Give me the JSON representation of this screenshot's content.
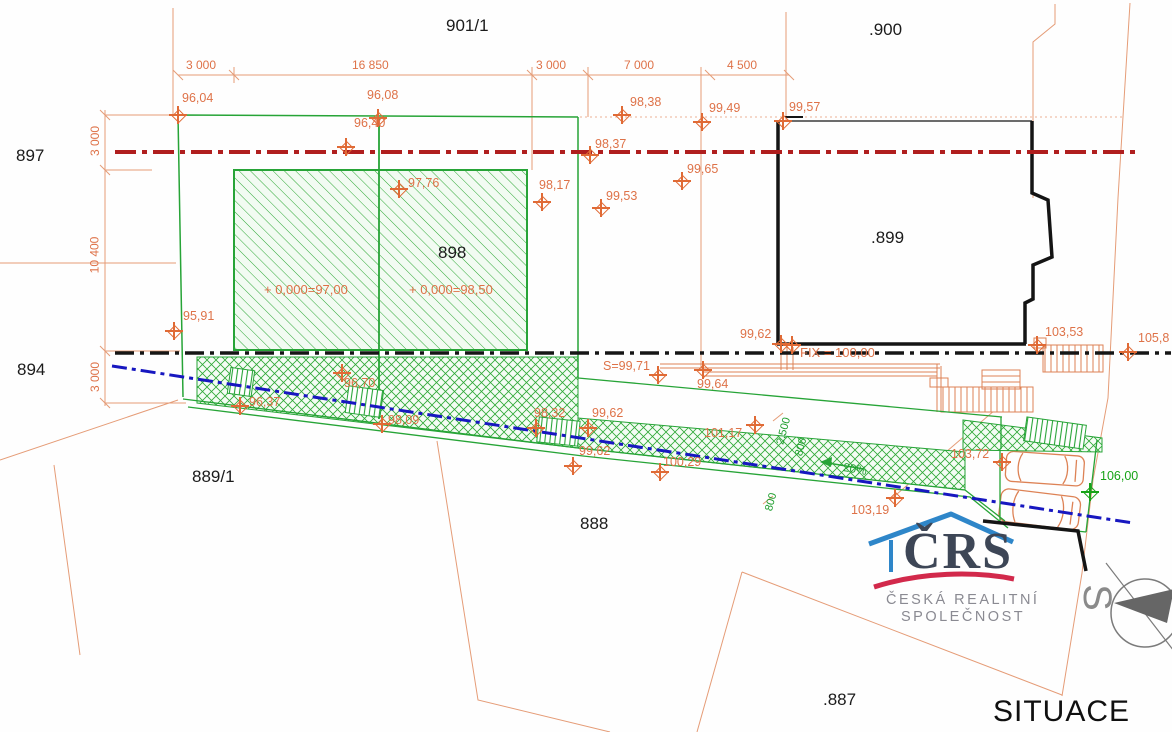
{
  "drawing_title": "SITUACE",
  "north_label": "S",
  "logo": {
    "name": "ČRS",
    "line1": "ČESKÁ REALITNÍ",
    "line2": "SPOLEČNOST"
  },
  "colors": {
    "green": "#27a437",
    "orange_text": "#de7248",
    "orange_line": "#e59c77",
    "red_axis": "#b01e1e",
    "black_axis": "#161616",
    "blue_axis": "#1717c0",
    "logo_blue": "#2e86c9",
    "logo_red": "#d2294b",
    "logo_gray": "#8a8a92"
  },
  "parcel_labels": [
    {
      "text": "901/1",
      "x": 446,
      "y": 16
    },
    {
      "text": ".900",
      "x": 869,
      "y": 20
    },
    {
      "text": "897",
      "x": 16,
      "y": 146
    },
    {
      "text": "894",
      "x": 17,
      "y": 360
    },
    {
      "text": "898",
      "x": 438,
      "y": 243
    },
    {
      "text": ".899",
      "x": 871,
      "y": 228
    },
    {
      "text": "889/1",
      "x": 192,
      "y": 467
    },
    {
      "text": "888",
      "x": 580,
      "y": 514
    },
    {
      "text": ".887",
      "x": 823,
      "y": 690
    }
  ],
  "dimension_labels_top": [
    {
      "text": "3 000",
      "x": 186,
      "y": 58
    },
    {
      "text": "16 850",
      "x": 352,
      "y": 58
    },
    {
      "text": "3 000",
      "x": 536,
      "y": 58
    },
    {
      "text": "7 000",
      "x": 624,
      "y": 58
    },
    {
      "text": "4 500",
      "x": 727,
      "y": 58
    }
  ],
  "dimension_labels_left": [
    {
      "text": "3 000",
      "x": 80,
      "y": 134
    },
    {
      "text": "10 400",
      "x": 76,
      "y": 248
    },
    {
      "text": "3 000",
      "x": 80,
      "y": 370
    }
  ],
  "dimension_labels_ramp": [
    {
      "text": "2,500",
      "x": 770,
      "y": 425,
      "rot": -75
    },
    {
      "text": "800",
      "x": 792,
      "y": 441,
      "rot": -75
    },
    {
      "text": "800",
      "x": 762,
      "y": 496,
      "rot": -75
    }
  ],
  "annotations": [
    {
      "text": "+ 0,000=97,00",
      "x": 264,
      "y": 282,
      "color": "orange"
    },
    {
      "text": "+ 0,000=98,50",
      "x": 409,
      "y": 282,
      "color": "orange"
    },
    {
      "text": "FIX = 100,00",
      "x": 800,
      "y": 345,
      "color": "orange"
    },
    {
      "text": "20%",
      "x": 843,
      "y": 462,
      "color": "green",
      "rot": 10
    }
  ],
  "elevation_points": [
    {
      "label": "96,04",
      "x": 178,
      "y": 115,
      "lx": 182,
      "ly": 91
    },
    {
      "label": "96,08",
      "x": 378,
      "y": 118,
      "lx": 367,
      "ly": 88
    },
    {
      "label": "96,40",
      "x": 346,
      "y": 147,
      "lx": 354,
      "ly": 116
    },
    {
      "label": "97,76",
      "x": 399,
      "y": 189,
      "lx": 408,
      "ly": 176
    },
    {
      "label": "98,17",
      "x": 542,
      "y": 202,
      "lx": 539,
      "ly": 178
    },
    {
      "label": "98,37",
      "x": 590,
      "y": 155,
      "lx": 595,
      "ly": 137
    },
    {
      "label": "98,38",
      "x": 622,
      "y": 115,
      "lx": 630,
      "ly": 95
    },
    {
      "label": "99,49",
      "x": 702,
      "y": 122,
      "lx": 709,
      "ly": 101
    },
    {
      "label": "99,57",
      "x": 783,
      "y": 121,
      "lx": 789,
      "ly": 100
    },
    {
      "label": "99,65",
      "x": 682,
      "y": 181,
      "lx": 687,
      "ly": 162
    },
    {
      "label": "99,53",
      "x": 601,
      "y": 208,
      "lx": 606,
      "ly": 189
    },
    {
      "label": "95,91",
      "x": 174,
      "y": 331,
      "lx": 183,
      "ly": 309
    },
    {
      "label": "96,37",
      "x": 240,
      "y": 406,
      "lx": 249,
      "ly": 395
    },
    {
      "label": "96,70",
      "x": 342,
      "y": 373,
      "lx": 344,
      "ly": 376
    },
    {
      "label": "98,09",
      "x": 382,
      "y": 424,
      "lx": 388,
      "ly": 413
    },
    {
      "label": "98,32",
      "x": 536,
      "y": 428,
      "lx": 534,
      "ly": 406
    },
    {
      "label": "99,62",
      "x": 588,
      "y": 428,
      "lx": 592,
      "ly": 406
    },
    {
      "label": "99,62",
      "x": 573,
      "y": 466,
      "lx": 579,
      "ly": 444
    },
    {
      "label": "100,29",
      "x": 660,
      "y": 472,
      "lx": 663,
      "ly": 455
    },
    {
      "label": "101,17",
      "x": 755,
      "y": 425,
      "lx": 704,
      "ly": 426
    },
    {
      "label": "S=99,71",
      "x": 658,
      "y": 375,
      "lx": 603,
      "ly": 359
    },
    {
      "label": "99,64",
      "x": 703,
      "y": 370,
      "lx": 697,
      "ly": 377
    },
    {
      "label": "99,62",
      "x": 781,
      "y": 344,
      "lx": 740,
      "ly": 327
    },
    {
      "label": "",
      "x": 792,
      "y": 345,
      "lx": 0,
      "ly": 0
    },
    {
      "label": "103,53",
      "x": 1037,
      "y": 345,
      "lx": 1045,
      "ly": 325
    },
    {
      "label": "105,8",
      "x": 1128,
      "y": 352,
      "lx": 1138,
      "ly": 331
    },
    {
      "label": "103,72",
      "x": 1002,
      "y": 462,
      "lx": 951,
      "ly": 447
    },
    {
      "label": "103,19",
      "x": 895,
      "y": 498,
      "lx": 851,
      "ly": 503
    },
    {
      "label": "106,00",
      "x": 1090,
      "y": 492,
      "lx": 1100,
      "ly": 469,
      "color": "green"
    }
  ]
}
